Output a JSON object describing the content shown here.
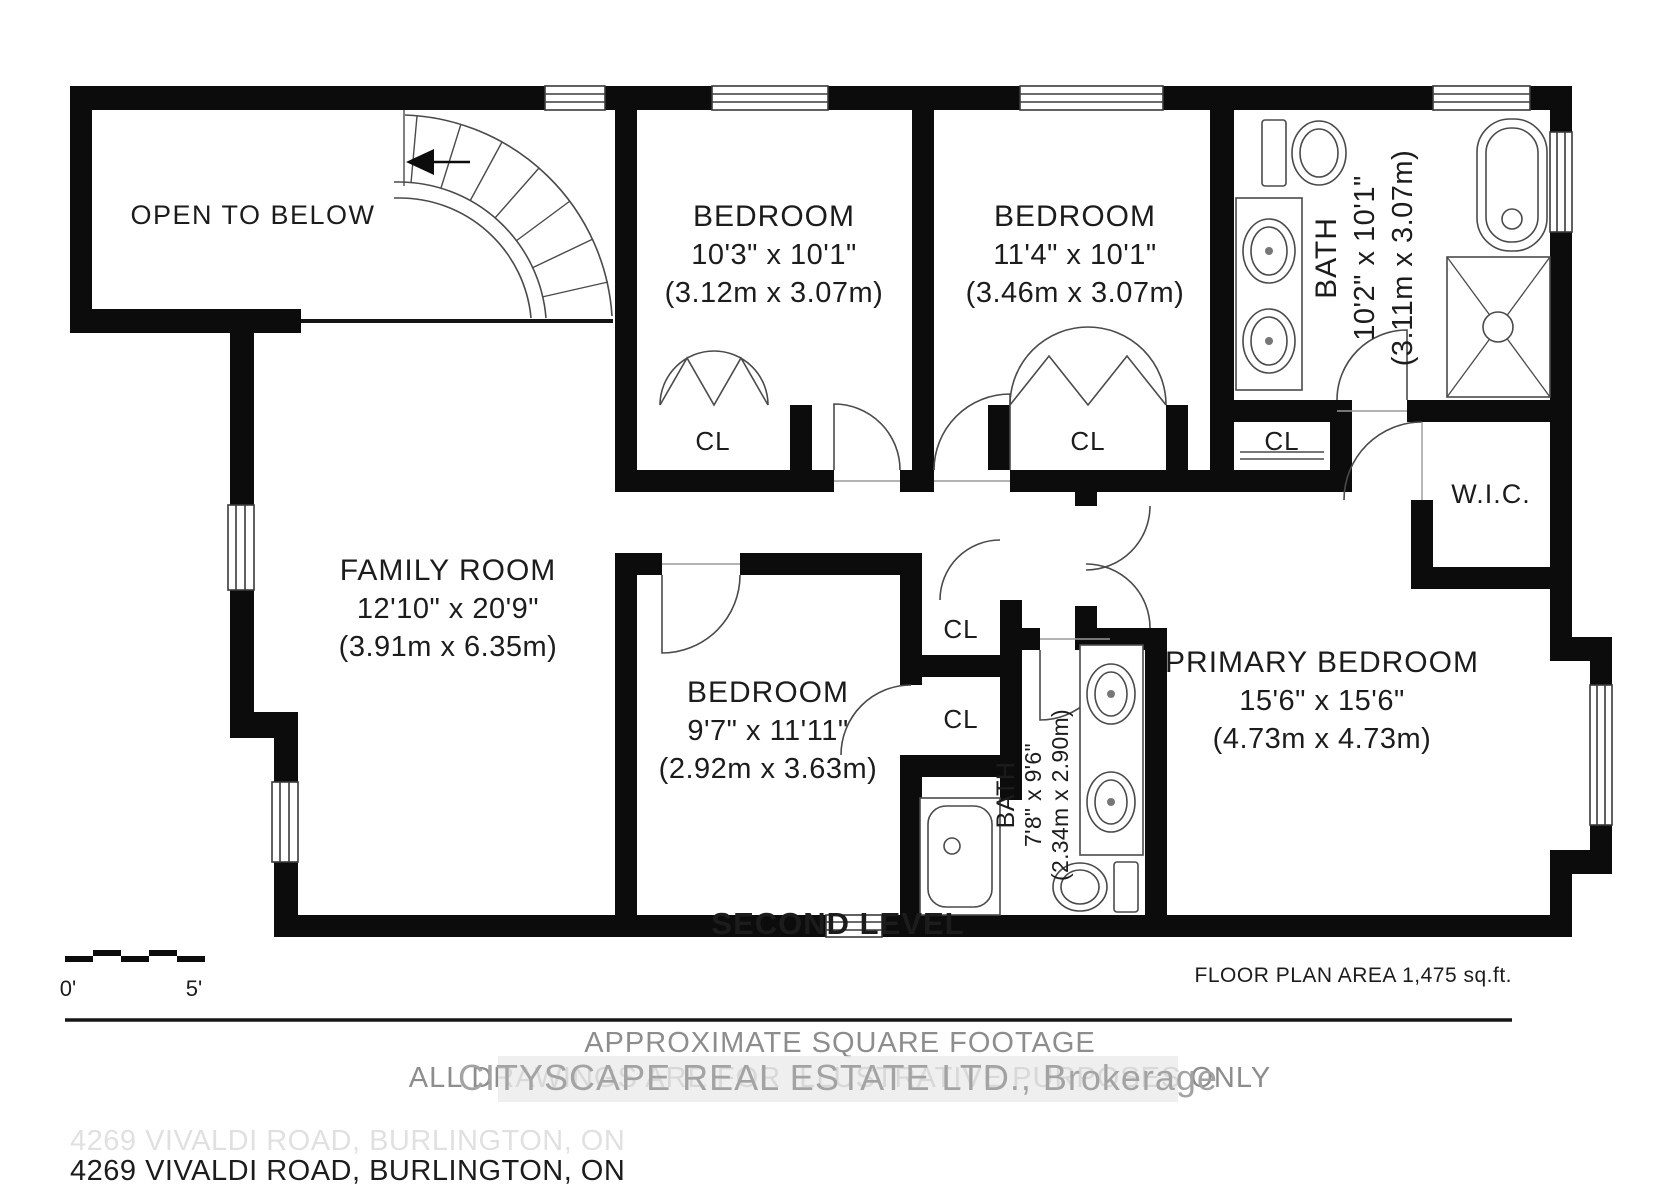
{
  "page": {
    "title_level": "SECOND LEVEL",
    "address": "4269 VIVALDI ROAD, BURLINGTON, ON"
  },
  "footer": {
    "approx": "APPROXIMATE SQUARE FOOTAGE",
    "illustrative": "ALL DRAWINGS ARE FOR ILLUSTRATIVE PURPOSES ONLY",
    "floor_area": "FLOOR PLAN AREA 1,475 sq.ft.",
    "watermark": "CITYSCAPE REAL ESTATE LTD., Brokerage"
  },
  "scale_bar": {
    "zero": "0'",
    "five": "5'"
  },
  "labels": {
    "closet": "CL",
    "wic": "W.I.C.",
    "open_to_below": "OPEN TO BELOW"
  },
  "rooms": {
    "bedroom1": {
      "name": "BEDROOM",
      "imperial": "10'3\" x 10'1\"",
      "metric": "(3.12m x 3.07m)"
    },
    "bedroom2": {
      "name": "BEDROOM",
      "imperial": "11'4\" x 10'1\"",
      "metric": "(3.46m x 3.07m)"
    },
    "bath_main": {
      "name": "BATH",
      "imperial": "10'2\" x 10'1\"",
      "metric": "(3.11m x 3.07m)"
    },
    "family": {
      "name": "FAMILY ROOM",
      "imperial": "12'10\" x 20'9\"",
      "metric": "(3.91m x 6.35m)"
    },
    "bedroom3": {
      "name": "BEDROOM",
      "imperial": "9'7\" x 11'11\"",
      "metric": "(2.92m x 3.63m)"
    },
    "bath_ensuite": {
      "name": "BATH",
      "imperial": "7'8\" x 9'6\"",
      "metric": "(2.34m x 2.90m)"
    },
    "primary": {
      "name": "PRIMARY BEDROOM",
      "imperial": "15'6\" x 15'6\"",
      "metric": "(4.73m x 4.73m)"
    }
  }
}
